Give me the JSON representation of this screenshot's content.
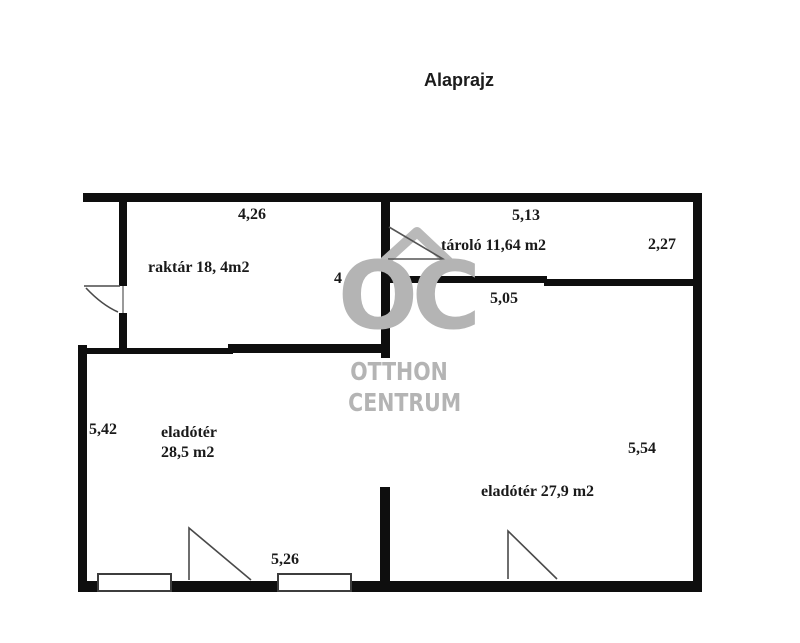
{
  "title": "Alaprajz",
  "watermark": {
    "logo": "OC",
    "line1": "OTTHON",
    "line2": "CENTRUM",
    "color": "#b4b4b4"
  },
  "rooms": {
    "raktar": {
      "label": "raktár 18, 4m2"
    },
    "tarolo": {
      "label": "tároló 11,64 m2"
    },
    "eladoter_1": {
      "name": "eladótér",
      "area": "28,5 m2"
    },
    "eladoter_2": {
      "label": "eladótér 27,9 m2"
    }
  },
  "dimensions": {
    "raktar_width": "4,26",
    "raktar_height": "4",
    "tarolo_width": "5,13",
    "tarolo_height": "2,27",
    "eladoter_2_width": "5,05",
    "eladoter_1_height": "5,42",
    "eladoter_2_height": "5,54",
    "eladoter_1_width": "5,26"
  },
  "colors": {
    "wall": "#0e0e0e",
    "text": "#1a1a1a",
    "door_line": "#4a4a4a"
  }
}
